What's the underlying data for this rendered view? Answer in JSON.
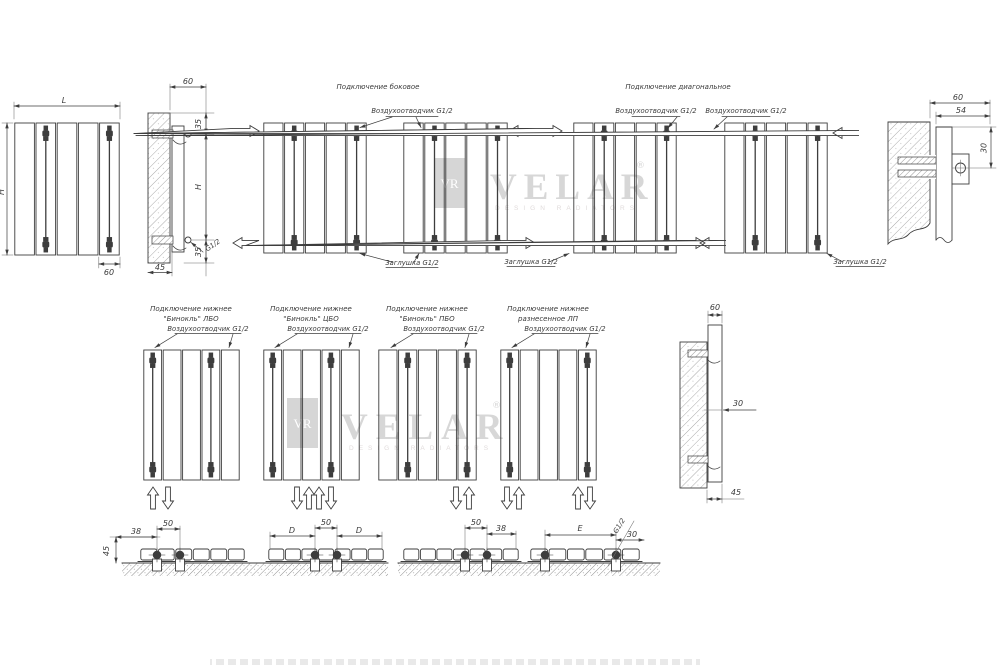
{
  "drawing": {
    "line_color": "#3d3d3d"
  },
  "watermarks": {
    "monogram": "VR",
    "brand": "VELAR",
    "tagline": "DESIGN RADIATORS",
    "registered": "®"
  },
  "top_row": {
    "front_view": {
      "width": "L",
      "height": "H",
      "section": "60"
    },
    "side_view_left": {
      "depth": "60",
      "top_offset": "35",
      "height": "H",
      "bottom_offset": "35",
      "wall_offset": "45",
      "thread": "G1/2"
    },
    "side_connection": {
      "title": "Подключение боковое",
      "air_vent": "Воздухоотводчик G1/2",
      "plug": "Заглушка G1/2"
    },
    "diagonal_connection": {
      "title": "Подключение диагональное",
      "air_vent_left": "Воздухоотводчик G1/2",
      "air_vent_right": "Воздухоотводчик G1/2",
      "plug_left": "Заглушка G1/2",
      "plug_right": "Заглушка G1/2"
    },
    "side_view_right": {
      "depth": "60",
      "width": "54",
      "axis_offset": "30"
    }
  },
  "middle_row": {
    "schemes": [
      {
        "title_line1": "Подключение нижнее",
        "title_line2": "\"Бинокль\" ЛБО",
        "air_vent": "Воздухоотводчик G1/2"
      },
      {
        "title_line1": "Подключение нижнее",
        "title_line2": "\"Бинокль\" ЦБО",
        "air_vent": "Воздухоотводчик G1/2"
      },
      {
        "title_line1": "Подключение нижнее",
        "title_line2": "\"Бинокль\" ПБО",
        "air_vent": "Воздухоотводчик G1/2"
      },
      {
        "title_line1": "Подключение нижнее",
        "title_line2": "разнесенное ЛП",
        "air_vent": "Воздухоотводчик G1/2"
      }
    ],
    "side_view": {
      "depth": "60",
      "axis_offset": "30",
      "wall_offset": "45"
    }
  },
  "bottom_row": {
    "detail_1": {
      "height": "45",
      "edge_offset": "38",
      "pitch": "50"
    },
    "detail_2": {
      "left_span": "D",
      "pitch": "50",
      "right_span": "D"
    },
    "detail_3": {
      "pitch": "50",
      "edge_offset": "38"
    },
    "detail_4": {
      "span": "E",
      "thread": "G1/2",
      "offset": "30"
    }
  }
}
